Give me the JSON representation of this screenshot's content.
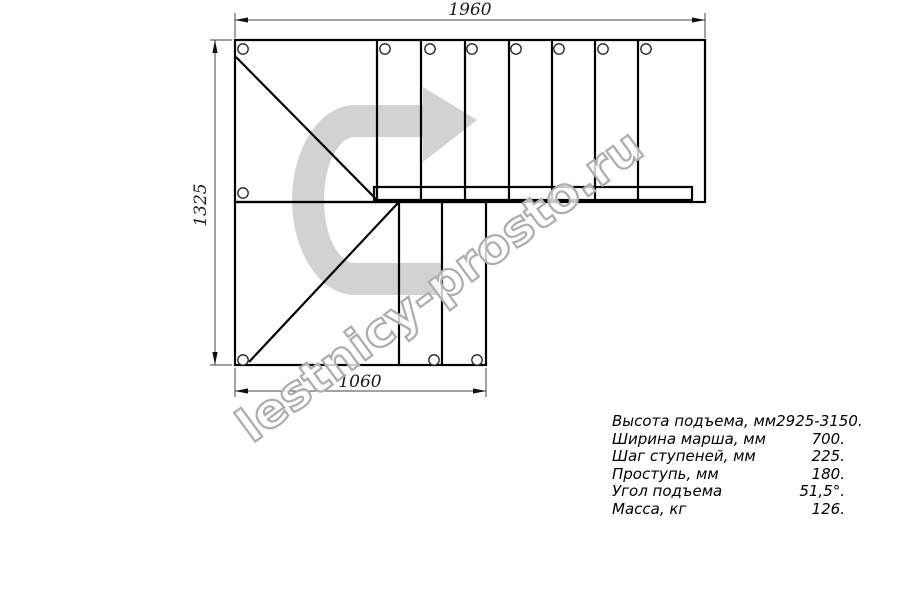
{
  "drawing": {
    "type": "staircase-plan-top-view",
    "dimensions": {
      "top_width": "1960",
      "left_height": "1325",
      "bottom_width": "1060"
    },
    "watermark": {
      "text": "lestnicy-prosto.ru",
      "arrow_color": "#d2d2d2",
      "text_outline_color": "#aeaeae"
    },
    "line_color": "#000000",
    "dim_line_color": "#444444"
  },
  "specs": {
    "rows": [
      {
        "label": "Высота подъема, мм",
        "value": "2925-3150."
      },
      {
        "label": "Ширина марша, мм",
        "value": "700."
      },
      {
        "label": "Шаг ступеней, мм",
        "value": "225."
      },
      {
        "label": "Проступь, мм",
        "value": "180."
      },
      {
        "label": "Угол подъема",
        "value": "51,5°."
      },
      {
        "label": "Масса, кг",
        "value": "126."
      }
    ]
  }
}
